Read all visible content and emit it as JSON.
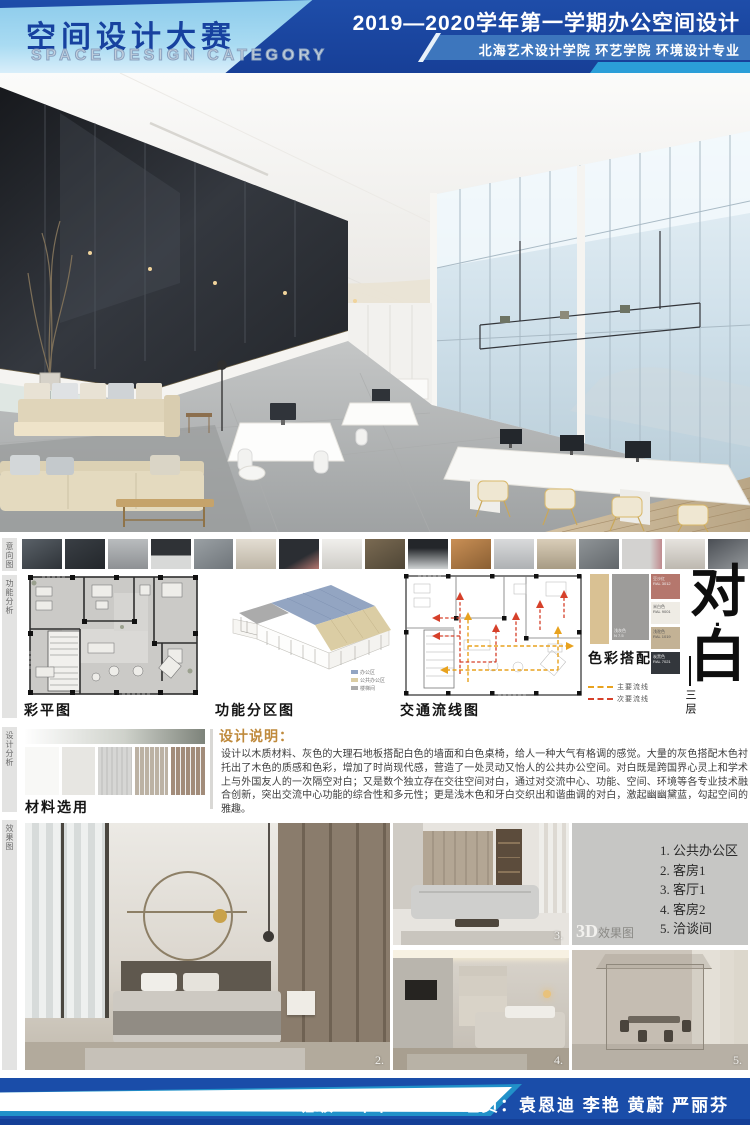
{
  "header": {
    "title_cn": "空间设计大赛",
    "title_en": "SPACE DESIGN CATEGORY",
    "course": "2019—2020学年第一学期办公空间设计",
    "school": "北海艺术设计学院  环艺学院  环境设计专业"
  },
  "sidebar_labels": [
    "意向图",
    "功能分析",
    "设计分析",
    "效果图"
  ],
  "thumbnails": [
    "linear-gradient(150deg,#5a6168,#2e3338)",
    "linear-gradient(150deg,#3a3f45,#23272b)",
    "linear-gradient(180deg,#b9bcbe,#8e9194)",
    "linear-gradient(180deg,#2f3236 55%,#d8d9d8 55%)",
    "linear-gradient(150deg,#9aa0a4,#6f757a)",
    "linear-gradient(180deg,#e3ddd2,#bdb5a6)",
    "linear-gradient(150deg,#2b2e33 60%,#b5766f)",
    "linear-gradient(180deg,#f0efec,#cfcdc8)",
    "linear-gradient(150deg,#7a6a52,#4f4636)",
    "linear-gradient(180deg,#23262a 30%,#cfd2d3)",
    "linear-gradient(150deg,#c98f55,#8a5f33)",
    "linear-gradient(180deg,#d9dadb,#aeb1b3)",
    "linear-gradient(180deg,#d9cdb8,#a79b84)",
    "linear-gradient(150deg,#8f9497,#62676b)",
    "linear-gradient(90deg,#d3d2d0 70%,#c08a8e)",
    "linear-gradient(180deg,#e6e3de,#bdb8b0)",
    "linear-gradient(150deg,#4a4e54,#95999c)"
  ],
  "plans": {
    "color_plan_label": "彩平图",
    "zoning_label": "功能分区图",
    "zoning_legend": [
      {
        "label": "办公区",
        "color": "#93a5c2"
      },
      {
        "label": "公共办公区",
        "color": "#dbcda4"
      },
      {
        "label": "楼梯间",
        "color": "#ababab"
      }
    ],
    "circulation_label": "交通流线图",
    "circulation_legend": [
      {
        "label": "主要流线",
        "color": "#e8a21e"
      },
      {
        "label": "次要流线",
        "color": "#d6402a"
      }
    ]
  },
  "color_scheme": {
    "label": "色彩搭配",
    "left_swatch_color": "#d9c193",
    "main_swatch": {
      "color": "#9d9c9a",
      "name": "浅灰色",
      "code": "N 7.5"
    },
    "accent_swatches": [
      {
        "color": "#b5776d",
        "name": "豆沙红",
        "code": "RAL 3012",
        "height": 25,
        "dark": true
      },
      {
        "color": "#efece5",
        "name": "米白色",
        "code": "RAL 9001",
        "height": 22,
        "dark": false
      },
      {
        "color": "#c3b295",
        "name": "浅驼色",
        "code": "RAL 1019",
        "height": 22,
        "dark": false
      },
      {
        "color": "#33373c",
        "name": "炭黑色",
        "code": "RAL 7021",
        "height": 22,
        "dark": true
      }
    ]
  },
  "concept": {
    "char_top": "对",
    "dot": "·",
    "char_bottom": "白",
    "floor": "三层"
  },
  "description": {
    "heading": "设计说明：",
    "body": "设计以木质材料、灰色的大理石地板搭配白色的墙面和白色桌椅，给人一种大气有格调的感觉。大量的灰色搭配木色衬托出了木色的质感和色彩，增加了时尚现代感，营造了一处灵动又怡人的公共办公空间。对白既是跨国界心灵上和学术上与外国友人的一次隔空对白；又是数个独立存在交往空间对白，通过对交流中心、功能、空间、环境等各专业技术融合创新，突出交流中心功能的综合性和多元性；更是浅木色和牙白交织出和谐曲调的对白，激起幽幽黛蓝，勾起空间的雅趣。"
  },
  "materials": {
    "label": "材料选用",
    "swatches": [
      "#f8f8f6",
      "#e7e6e2",
      "#d6d6d4",
      "#bcb2a4",
      "#a28c7a"
    ]
  },
  "renders": {
    "tag_3d": "3D",
    "tag_suffix": "效果图",
    "list": [
      "1. 公共办公区",
      "2. 客房1",
      "3. 客厅1",
      "4. 客房2",
      "5. 洽谈间"
    ],
    "numbers": {
      "bedroom": "2.",
      "living": "3.",
      "bedroom2": "4.",
      "meeting": "5."
    }
  },
  "footer": {
    "class_info": "班级：环本1707",
    "members": "组员：袁恩迪  李艳  黄蔚  严丽芬"
  }
}
